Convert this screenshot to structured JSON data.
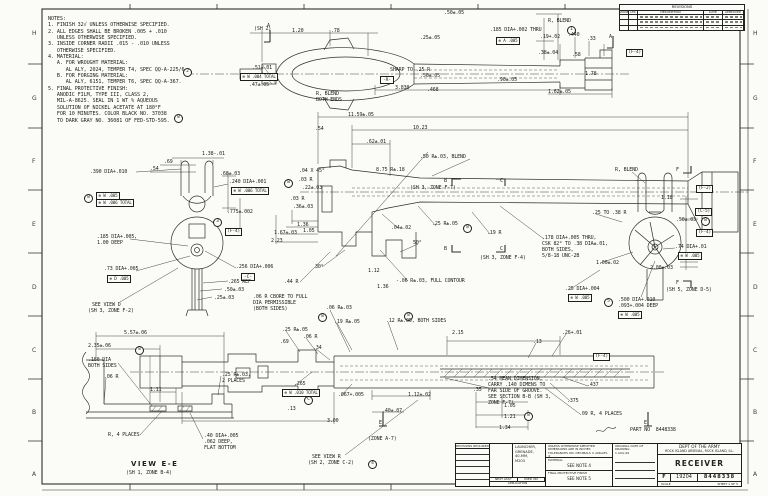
{
  "sheet": {
    "zones": [
      "H",
      "G",
      "F",
      "E",
      "D",
      "C",
      "B",
      "A"
    ],
    "zone_ys": [
      30,
      95,
      158,
      221,
      284,
      347,
      409,
      471
    ],
    "line_color": "#2e2e2e",
    "paper_color": "#fbfbf7"
  },
  "notes": {
    "lines": [
      "NOTES:",
      "1. FINISH 32√ UNLESS OTHERWISE SPECIFIED.",
      "2. ALL EDGES SHALL BE BROKEN .005 + .010",
      "   UNLESS OTHERWISE SPECIFIED.",
      "3. INSIDE CORNER RADII .015 - .010 UNLESS",
      "   OTHERWISE SPECIFIED.",
      "4. MATERIAL:",
      "   A. FOR WROUGHT MATERIAL:",
      "      AL ALY, 2024, TEMPER T4, SPEC QQ-A-225/6.",
      "   B. FOR FORGING MATERIAL:",
      "      AL ALY, 6151, TEMPER T6, SPEC QQ-A-367.",
      "5. FINAL PROTECTIVE FINISH:",
      "   ANODIC FILM, TYPE III, CLASS 2,",
      "   MIL-A-8625. SEAL IN 1 WT % AQUEOUS",
      "   SOLUTION OF NICKEL ACETATE AT 180°F",
      "   FOR 10 MINUTES. COLOR BLACK NO. 37038",
      "   TO DARK GRAY NO. 36081 OF FED-STD-595."
    ]
  },
  "revisions": {
    "title": "REVISIONS",
    "columns": [
      "ZONE",
      "LTR",
      "DESCRIPTION",
      "DATE",
      "APPROVED"
    ],
    "row_count": 3
  },
  "title_block": {
    "part_no": "PART NO  8448338",
    "left_header": "REVISIONS REQUIRED",
    "application_lines": [
      "LAUNCHER,",
      "GRENADE,",
      "40-MM,",
      "M203"
    ],
    "next_assy_label": "NEXT ASSY",
    "used_on_label": "USED ON",
    "application_label": "APPLICATION",
    "tol_line1": "UNLESS OTHERWISE SPECIFIED",
    "tol_line2": "DIMENSIONS ARE IN INCHES",
    "tol_line3": "TOLERANCES ON: DECIMALS ±  ANGLES ±",
    "material_label": "MATERIAL",
    "material_value": "SEE NOTE 4",
    "finish_label": "FINAL PROTECTIVE FINISH",
    "finish_value": "SEE NOTE 5",
    "date_label": "ORIGINAL DATE OF DRAWING",
    "date_value": "1 AUG 69",
    "agency1": "DEPT OF THE ARMY",
    "agency2": "ROCK ISLAND ARSENAL, ROCK ISLAND, ILL.",
    "title": "RECEIVER",
    "size": "F",
    "fscm": "19204",
    "dwg_no": "8448338",
    "scale_label": "SCALE",
    "sheet_label": "SHEET 1 OF 5"
  },
  "annotations": [
    {
      "t": "1.20",
      "x": 292,
      "y": 29
    },
    {
      "t": ".78",
      "x": 331,
      "y": 29
    },
    {
      "t": ".50±.05",
      "x": 444,
      "y": 11
    },
    {
      "t": ".25±.05",
      "x": 420,
      "y": 36
    },
    {
      "t": ".185 DIA+.002 THRU",
      "x": 490,
      "y": 28
    },
    {
      "t": "1",
      "x": 567,
      "y": 26,
      "k": "c"
    },
    {
      "t": "⊕ A .005",
      "x": 496,
      "y": 37,
      "k": "g"
    },
    {
      "t": "R, BLEND",
      "x": 548,
      "y": 19
    },
    {
      "t": "(SH 2)",
      "x": 254,
      "y": 27
    },
    {
      "t": "A",
      "x": 267,
      "y": 24
    },
    {
      "t": ".51±.01",
      "x": 252,
      "y": 66
    },
    {
      "t": "⊕ W .004 TOTAL",
      "x": 240,
      "y": 73,
      "k": "g"
    },
    {
      "t": ".47±.05",
      "x": 249,
      "y": 83
    },
    {
      "t": "-R-",
      "x": 380,
      "y": 76,
      "k": "d"
    },
    {
      "t": "R, BLEND",
      "x": 316,
      "y": 92
    },
    {
      "t": "BOTH ENDS",
      "x": 316,
      "y": 98
    },
    {
      "t": "SHARP TO .25 R",
      "x": 390,
      "y": 68
    },
    {
      "t": "3.830",
      "x": 395,
      "y": 86
    },
    {
      "t": ".468",
      "x": 427,
      "y": 88
    },
    {
      "t": ".50±.05",
      "x": 420,
      "y": 74
    },
    {
      "t": ".90±.05",
      "x": 497,
      "y": 78
    },
    {
      "t": ".19+.02",
      "x": 540,
      "y": 35
    },
    {
      "t": ".440",
      "x": 568,
      "y": 33
    },
    {
      "t": ".33",
      "x": 587,
      "y": 37
    },
    {
      "t": ".38±.04",
      "x": 538,
      "y": 51
    },
    {
      "t": ".58",
      "x": 572,
      "y": 53
    },
    {
      "t": "1.78",
      "x": 585,
      "y": 72
    },
    {
      "t": "1.62±.05",
      "x": 548,
      "y": 90
    },
    {
      "t": "A",
      "x": 609,
      "y": 35
    },
    {
      "t": "(F-4)",
      "x": 626,
      "y": 49,
      "k": "b"
    },
    {
      "t": "1.38-.01",
      "x": 202,
      "y": 152
    },
    {
      "t": ".69",
      "x": 164,
      "y": 160
    },
    {
      "t": ".54",
      "x": 150,
      "y": 167
    },
    {
      "t": ".68±.03",
      "x": 220,
      "y": 172
    },
    {
      "t": ".390 DIA+.010",
      "x": 90,
      "y": 170
    },
    {
      "t": "8",
      "x": 84,
      "y": 194,
      "k": "c"
    },
    {
      "t": "⊕ W .005",
      "x": 96,
      "y": 192,
      "k": "g"
    },
    {
      "t": "⊕ W .006 TOTAL",
      "x": 96,
      "y": 199,
      "k": "g"
    },
    {
      "t": ".240 DIA+.001",
      "x": 229,
      "y": 180
    },
    {
      "t": "8",
      "x": 284,
      "y": 179,
      "k": "c"
    },
    {
      "t": "⊕ W .006 TOTAL",
      "x": 231,
      "y": 187,
      "k": "g"
    },
    {
      "t": ".775±.002",
      "x": 227,
      "y": 210
    },
    {
      "t": "3",
      "x": 213,
      "y": 218,
      "k": "c"
    },
    {
      "t": "(F-4)",
      "x": 225,
      "y": 228,
      "k": "b"
    },
    {
      "t": ".185 DIA+.005,",
      "x": 97,
      "y": 235
    },
    {
      "t": "1.00 DEEP",
      "x": 97,
      "y": 241
    },
    {
      "t": ".73 DIA+.005",
      "x": 104,
      "y": 267
    },
    {
      "t": "⊕ D .005",
      "x": 107,
      "y": 275,
      "k": "g"
    },
    {
      "t": "SEE VIEW D",
      "x": 92,
      "y": 303
    },
    {
      "t": "(SH 3, ZONE F-2)",
      "x": 88,
      "y": 309
    },
    {
      "t": ".256 DIA+.006",
      "x": 236,
      "y": 265
    },
    {
      "t": "-C-",
      "x": 241,
      "y": 273,
      "k": "d"
    },
    {
      "t": ".265 REF",
      "x": 228,
      "y": 280
    },
    {
      "t": ".50±.03",
      "x": 224,
      "y": 288
    },
    {
      "t": ".25±.03",
      "x": 214,
      "y": 296
    },
    {
      "t": "11.59±.05",
      "x": 348,
      "y": 113
    },
    {
      "t": ".54",
      "x": 315,
      "y": 127
    },
    {
      "t": "10.23",
      "x": 413,
      "y": 126
    },
    {
      "t": ".62±.01",
      "x": 366,
      "y": 140
    },
    {
      "t": ".50 R±.03, BLEND",
      "x": 420,
      "y": 155
    },
    {
      "t": "8.75 R±.18",
      "x": 376,
      "y": 168
    },
    {
      "t": ".04 X 45°",
      "x": 299,
      "y": 169
    },
    {
      "t": ".03 R",
      "x": 298,
      "y": 178
    },
    {
      "t": ".22±.03",
      "x": 302,
      "y": 186
    },
    {
      "t": ".03 R",
      "x": 290,
      "y": 197
    },
    {
      "t": ".36±.03",
      "x": 293,
      "y": 205
    },
    {
      "t": "B",
      "x": 444,
      "y": 179
    },
    {
      "t": "(SH 3, ZONE F-7)",
      "x": 410,
      "y": 186
    },
    {
      "t": "C",
      "x": 500,
      "y": 179
    },
    {
      "t": "1.36",
      "x": 297,
      "y": 223
    },
    {
      "t": "1.05",
      "x": 303,
      "y": 229
    },
    {
      "t": "1.67±.03",
      "x": 274,
      "y": 231
    },
    {
      "t": "2.23",
      "x": 271,
      "y": 239
    },
    {
      "t": ".04±.02",
      "x": 391,
      "y": 226
    },
    {
      "t": ".25 R±.05",
      "x": 432,
      "y": 222
    },
    {
      "t": "8",
      "x": 463,
      "y": 224,
      "k": "c"
    },
    {
      "t": ".19 R",
      "x": 487,
      "y": 231
    },
    {
      "t": "B",
      "x": 444,
      "y": 247
    },
    {
      "t": "C",
      "x": 500,
      "y": 247
    },
    {
      "t": "(SH 3, ZONE F-4)",
      "x": 480,
      "y": 256
    },
    {
      "t": ".178 DIA+.005 THRU,",
      "x": 542,
      "y": 236
    },
    {
      "t": "CSK 82° TO .38 DIA±.01,",
      "x": 542,
      "y": 242
    },
    {
      "t": "BOTH SIDES,",
      "x": 542,
      "y": 248
    },
    {
      "t": "5/8-18 UNC-2B",
      "x": 542,
      "y": 254
    },
    {
      "t": "30°",
      "x": 315,
      "y": 265
    },
    {
      "t": "50°",
      "x": 413,
      "y": 241
    },
    {
      "t": ".44 R",
      "x": 284,
      "y": 280
    },
    {
      "t": "1.12",
      "x": 368,
      "y": 269
    },
    {
      "t": "1.36",
      "x": 377,
      "y": 285
    },
    {
      "t": "-.06 R±.03, FULL CONTOUR",
      "x": 396,
      "y": 279
    },
    {
      "t": ".06 R CBORE TO FULL",
      "x": 253,
      "y": 295
    },
    {
      "t": "DIA PERMISSIBLE",
      "x": 253,
      "y": 301
    },
    {
      "t": "(BOTH SIDES)",
      "x": 253,
      "y": 307
    },
    {
      "t": "R, BLEND",
      "x": 615,
      "y": 168
    },
    {
      "t": "F",
      "x": 676,
      "y": 168
    },
    {
      "t": "(F-2)",
      "x": 696,
      "y": 185,
      "k": "b"
    },
    {
      "t": "1.18",
      "x": 661,
      "y": 196
    },
    {
      "t": "(C-5)",
      "x": 695,
      "y": 208,
      "k": "b"
    },
    {
      "t": ".50±.03",
      "x": 676,
      "y": 218
    },
    {
      "t": "8",
      "x": 701,
      "y": 217,
      "k": "c"
    },
    {
      "t": ".25 TO .38 R",
      "x": 592,
      "y": 211
    },
    {
      "t": "(F-4)",
      "x": 696,
      "y": 229,
      "k": "b"
    },
    {
      "t": ".74 DIA+.01",
      "x": 675,
      "y": 245
    },
    {
      "t": "⊕ W .005",
      "x": 678,
      "y": 252,
      "k": "g"
    },
    {
      "t": "1.00±.02",
      "x": 596,
      "y": 261
    },
    {
      "t": "2.00±.03",
      "x": 650,
      "y": 266
    },
    {
      "t": ".25 DIA+.004",
      "x": 565,
      "y": 287
    },
    {
      "t": "⊕ W .005",
      "x": 568,
      "y": 294,
      "k": "g"
    },
    {
      "t": "5",
      "x": 604,
      "y": 298,
      "k": "c"
    },
    {
      "t": ".500 DIA+.010",
      "x": 618,
      "y": 298
    },
    {
      "t": ".093+.004 DEEP",
      "x": 618,
      "y": 304
    },
    {
      "t": "⊕ W .005",
      "x": 618,
      "y": 311,
      "k": "g"
    },
    {
      "t": "F",
      "x": 676,
      "y": 281
    },
    {
      "t": "(SH 5, ZONE D-5)",
      "x": 666,
      "y": 288
    },
    {
      "t": ".06 R±.03",
      "x": 326,
      "y": 306
    },
    {
      "t": "8",
      "x": 318,
      "y": 313,
      "k": "c"
    },
    {
      "t": ".19 R±.05",
      "x": 334,
      "y": 320
    },
    {
      "t": "8",
      "x": 404,
      "y": 312,
      "k": "c"
    },
    {
      "t": ".12 R±.05, BOTH SIDES",
      "x": 386,
      "y": 319
    },
    {
      "t": ".25 R±.05",
      "x": 282,
      "y": 328
    },
    {
      "t": ".06 R",
      "x": 303,
      "y": 335
    },
    {
      "t": "2.15",
      "x": 452,
      "y": 331
    },
    {
      "t": ".69",
      "x": 280,
      "y": 340
    },
    {
      "t": ".34",
      "x": 313,
      "y": 346
    },
    {
      "t": ".265",
      "x": 294,
      "y": 382
    },
    {
      "t": "⊕ W .010 TOTAL",
      "x": 282,
      "y": 389,
      "k": "g"
    },
    {
      "t": "C",
      "x": 304,
      "y": 396,
      "k": "c"
    },
    {
      "t": ".067+.005",
      "x": 338,
      "y": 393
    },
    {
      "t": "1.12±.02",
      "x": 408,
      "y": 393
    },
    {
      "t": ".13",
      "x": 287,
      "y": 407
    },
    {
      "t": ".40±.07",
      "x": 382,
      "y": 409
    },
    {
      "t": "3.00",
      "x": 327,
      "y": 419
    },
    {
      "t": ".35",
      "x": 473,
      "y": 388
    },
    {
      "t": "1.05",
      "x": 504,
      "y": 404
    },
    {
      "t": "1.21",
      "x": 504,
      "y": 415
    },
    {
      "t": "1.34",
      "x": 499,
      "y": 426
    },
    {
      "t": ".26+.01",
      "x": 562,
      "y": 331
    },
    {
      "t": ".13",
      "x": 533,
      "y": 340
    },
    {
      "t": "(F-4)",
      "x": 593,
      "y": 353,
      "k": "b"
    },
    {
      "t": ".437",
      "x": 587,
      "y": 383
    },
    {
      "t": ".375",
      "x": 567,
      "y": 399
    },
    {
      "t": ".09 R, 4 PLACES",
      "x": 579,
      "y": 412
    },
    {
      "t": "8",
      "x": 524,
      "y": 412,
      "k": "c"
    },
    {
      "t": ".54 MEAN DIMENSION,",
      "x": 488,
      "y": 377
    },
    {
      "t": "CARRY .140 DIMENS TO",
      "x": 488,
      "y": 383
    },
    {
      "t": "FAR SIDE OF GROOVE.",
      "x": 488,
      "y": 389
    },
    {
      "t": "SEE SECTION B-B (SH 3,",
      "x": 488,
      "y": 395
    },
    {
      "t": "ZONE F-7)",
      "x": 488,
      "y": 401
    },
    {
      "t": "E",
      "x": 379,
      "y": 421
    },
    {
      "t": "(ZONE A-7)",
      "x": 368,
      "y": 437
    },
    {
      "t": "E",
      "x": 644,
      "y": 421
    },
    {
      "t": "SEE VIEW R",
      "x": 312,
      "y": 455
    },
    {
      "t": "(SH 2, ZONE C-2)",
      "x": 308,
      "y": 461
    },
    {
      "t": "4",
      "x": 368,
      "y": 460,
      "k": "c"
    },
    {
      "t": "5.57±.06",
      "x": 124,
      "y": 331
    },
    {
      "t": "2.35±.06",
      "x": 88,
      "y": 344
    },
    {
      "t": "8",
      "x": 135,
      "y": 346,
      "k": "c"
    },
    {
      "t": ".180 DIA",
      "x": 88,
      "y": 358
    },
    {
      "t": "BOTH SIDES",
      "x": 88,
      "y": 364
    },
    {
      "t": ".06 R",
      "x": 104,
      "y": 375
    },
    {
      "t": ".25 R±.03,",
      "x": 222,
      "y": 373
    },
    {
      "t": "2 PLACES",
      "x": 222,
      "y": 379
    },
    {
      "t": "1.11",
      "x": 150,
      "y": 388
    },
    {
      "t": "R, 4 PLACES",
      "x": 108,
      "y": 433
    },
    {
      "t": ".40 DIA+.005",
      "x": 204,
      "y": 434
    },
    {
      "t": ".062 DEEP,",
      "x": 204,
      "y": 440
    },
    {
      "t": "FLAT BOTTOM",
      "x": 204,
      "y": 446
    },
    {
      "t": "VIEW E-E",
      "x": 131,
      "y": 461,
      "k": "v"
    },
    {
      "t": "(SH 1, ZONE B-4)",
      "x": 126,
      "y": 471
    },
    {
      "t": "2",
      "x": 183,
      "y": 68,
      "k": "c"
    },
    {
      "t": "8",
      "x": 174,
      "y": 114,
      "k": "c"
    },
    {
      "t": "PART NO  8448338",
      "x": 630,
      "y": 428
    }
  ]
}
